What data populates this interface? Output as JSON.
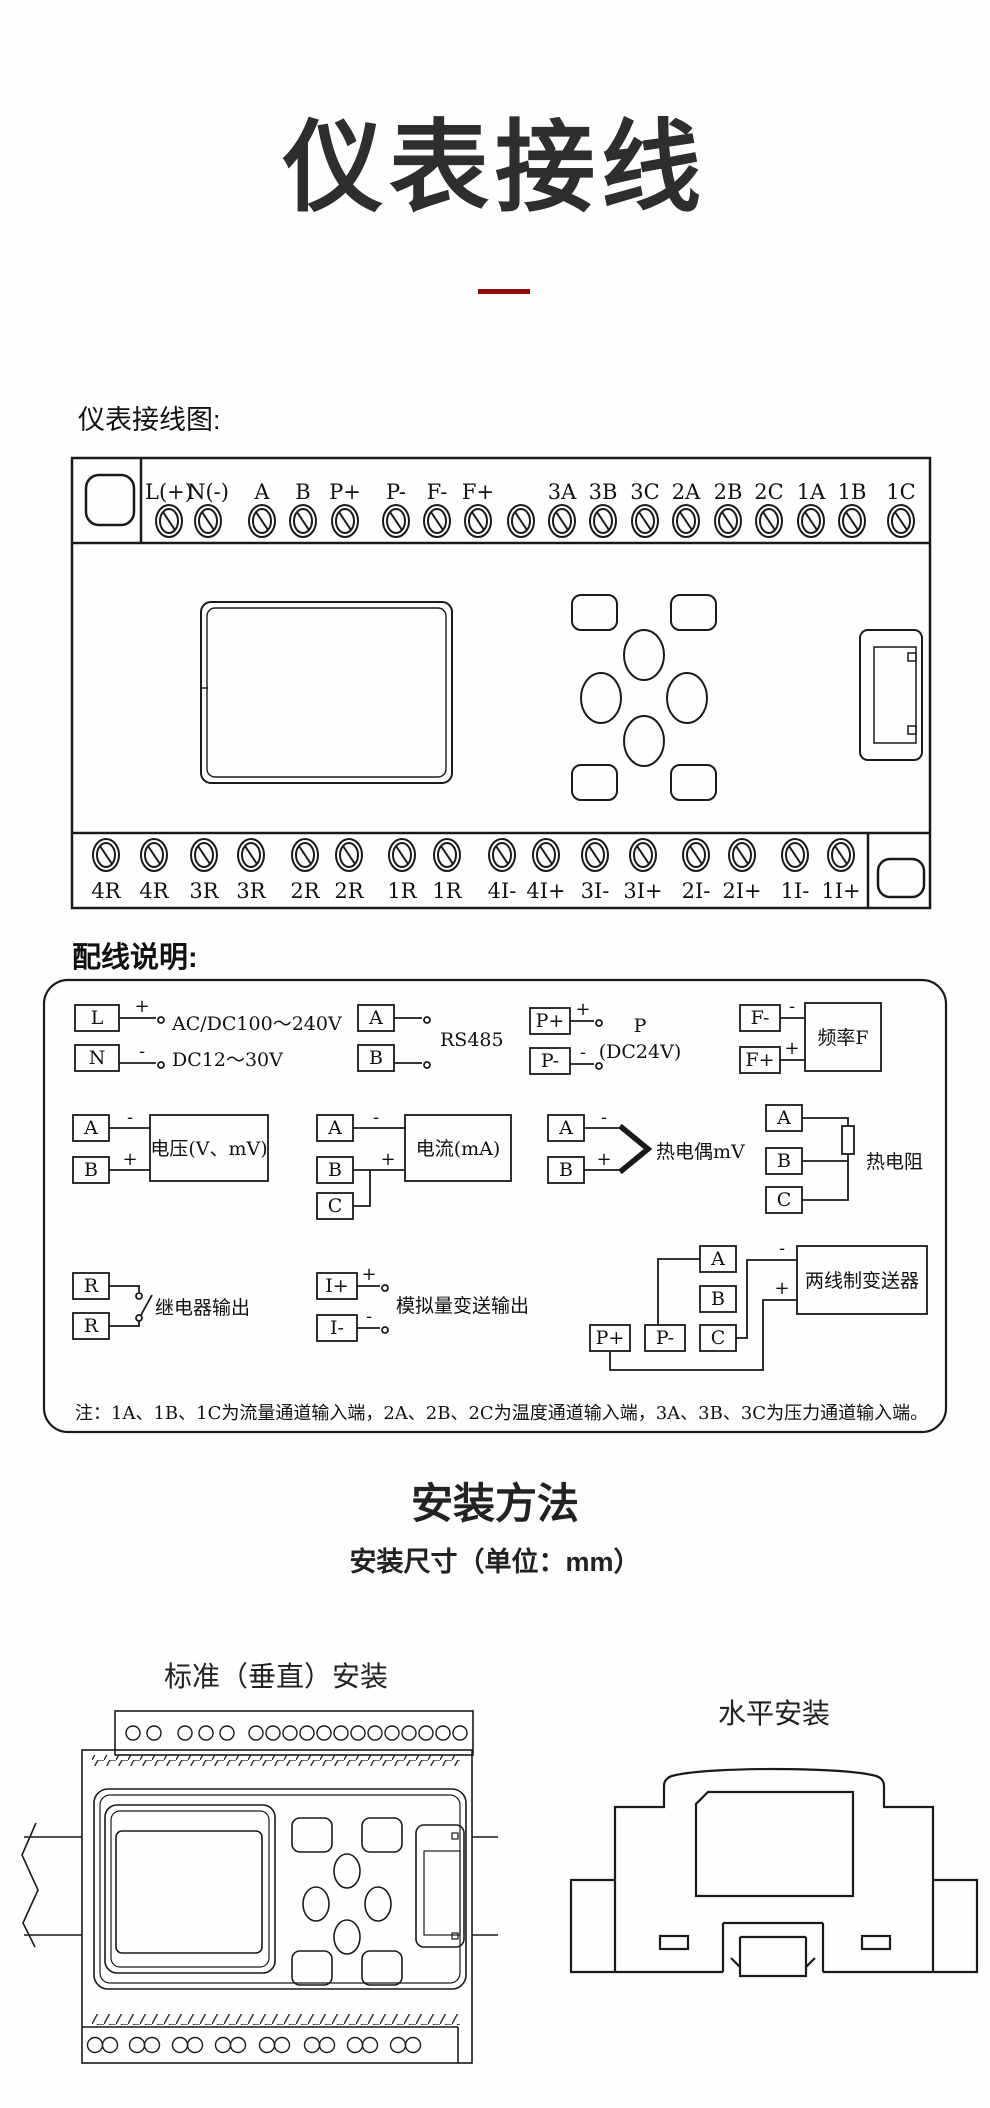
{
  "page": {
    "background": "#ffffff",
    "line_color": "#1a1a1a",
    "accent_color": "#8b0d0d"
  },
  "header": {
    "title": "仪表接线"
  },
  "labels": {
    "wiring_diagram": "仪表接线图:",
    "wiring_notes": "配线说明:",
    "install_method": "安装方法",
    "install_dims": "安装尺寸（单位：mm）",
    "vertical_install": "标准（垂直）安装",
    "horizontal_install": "水平安装"
  },
  "terminals": {
    "top": [
      "L(+)",
      "N(-)",
      "A",
      "B",
      "P+",
      "P-",
      "F-",
      "F+",
      "",
      "3A",
      "3B",
      "3C",
      "2A",
      "2B",
      "2C",
      "1A",
      "1B",
      "1C"
    ],
    "bottom": [
      "4R",
      "4R",
      "3R",
      "3R",
      "2R",
      "2R",
      "1R",
      "1R",
      "4I-",
      "4I+",
      "3I-",
      "3I+",
      "2I-",
      "2I+",
      "1I-",
      "1I+"
    ]
  },
  "signs": {
    "plus": "+",
    "minus": "-"
  },
  "wiring": {
    "power": {
      "t1": "L",
      "t2": "N",
      "line1": "AC/DC100～240V",
      "line2": "DC12～30V"
    },
    "rs485": {
      "t1": "A",
      "t2": "B",
      "label": "RS485"
    },
    "pressure_supply": {
      "t1": "P+",
      "t2": "P-",
      "line1": "P",
      "line2": "(DC24V)"
    },
    "frequency": {
      "t1": "F-",
      "t2": "F+",
      "box": "频率F"
    },
    "voltage": {
      "t1": "A",
      "t2": "B",
      "box": "电压(V、mV)"
    },
    "current": {
      "t1": "A",
      "t2": "B",
      "t3": "C",
      "box": "电流(mA)"
    },
    "thermocouple": {
      "t1": "A",
      "t2": "B",
      "label": "热电偶mV"
    },
    "rtd": {
      "t1": "A",
      "t2": "B",
      "t3": "C",
      "label": "热电阻"
    },
    "relay": {
      "t1": "R",
      "t2": "R",
      "label": "继电器输出"
    },
    "analog_output": {
      "t1": "I+",
      "t2": "I-",
      "label": "模拟量变送输出"
    },
    "transmitter": {
      "t1": "A",
      "t2": "B",
      "t3": "C",
      "t4": "P+",
      "t5": "P-",
      "box": "两线制变送器"
    }
  },
  "note": "注：1A、1B、1C为流量通道输入端，2A、2B、2C为温度通道输入端，3A、3B、3C为压力通道输入端。"
}
